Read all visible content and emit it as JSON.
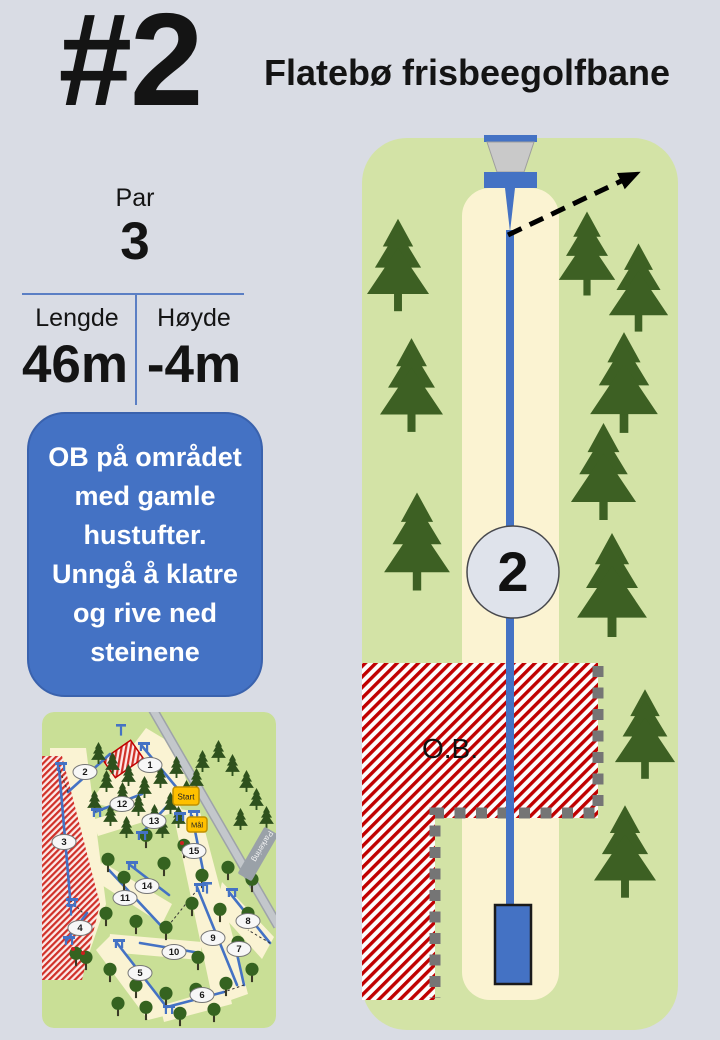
{
  "header": {
    "hole_number": "#2",
    "course_title": "Flatebø frisbeegolfbane"
  },
  "stats": {
    "par_label": "Par",
    "par_value": "3",
    "length_label": "Lengde",
    "length_value": "46m",
    "height_label": "Høyde",
    "height_value": "-4m"
  },
  "note": {
    "lines": [
      "OB på området",
      "med gamle",
      "hustufter.",
      "Unngå å klatre",
      "og rive ned",
      "steinene"
    ]
  },
  "diagram": {
    "hole_marker_label": "2",
    "ob_label": "O.B."
  },
  "minimap": {
    "start_label": "Start",
    "goal_label": "Mål",
    "parking_label": "Parkering",
    "holes": [
      {
        "label": "1",
        "x": 108,
        "y": 53
      },
      {
        "label": "2",
        "x": 43,
        "y": 60
      },
      {
        "label": "3",
        "x": 22,
        "y": 130
      },
      {
        "label": "4",
        "x": 38,
        "y": 216
      },
      {
        "label": "5",
        "x": 98,
        "y": 261
      },
      {
        "label": "6",
        "x": 160,
        "y": 283
      },
      {
        "label": "7",
        "x": 197,
        "y": 237
      },
      {
        "label": "8",
        "x": 206,
        "y": 209
      },
      {
        "label": "9",
        "x": 171,
        "y": 226
      },
      {
        "label": "10",
        "x": 132,
        "y": 240
      },
      {
        "label": "11",
        "x": 83,
        "y": 186
      },
      {
        "label": "12",
        "x": 80,
        "y": 92
      },
      {
        "label": "13",
        "x": 112,
        "y": 109
      },
      {
        "label": "14",
        "x": 105,
        "y": 174
      },
      {
        "label": "15",
        "x": 152,
        "y": 139
      }
    ]
  },
  "colors": {
    "page_background": "#d9dce4",
    "accent_blue": "#4472c4",
    "panel_green": "#d3e3a6",
    "minimap_green": "#c9df96",
    "fairway_cream": "#fbf3d2",
    "tree_green": "#3d6023",
    "ob_red": "#c00000",
    "boundary_gray": "#757575",
    "basket_gray": "#c9c9c9",
    "start_orange": "#ffc000"
  }
}
